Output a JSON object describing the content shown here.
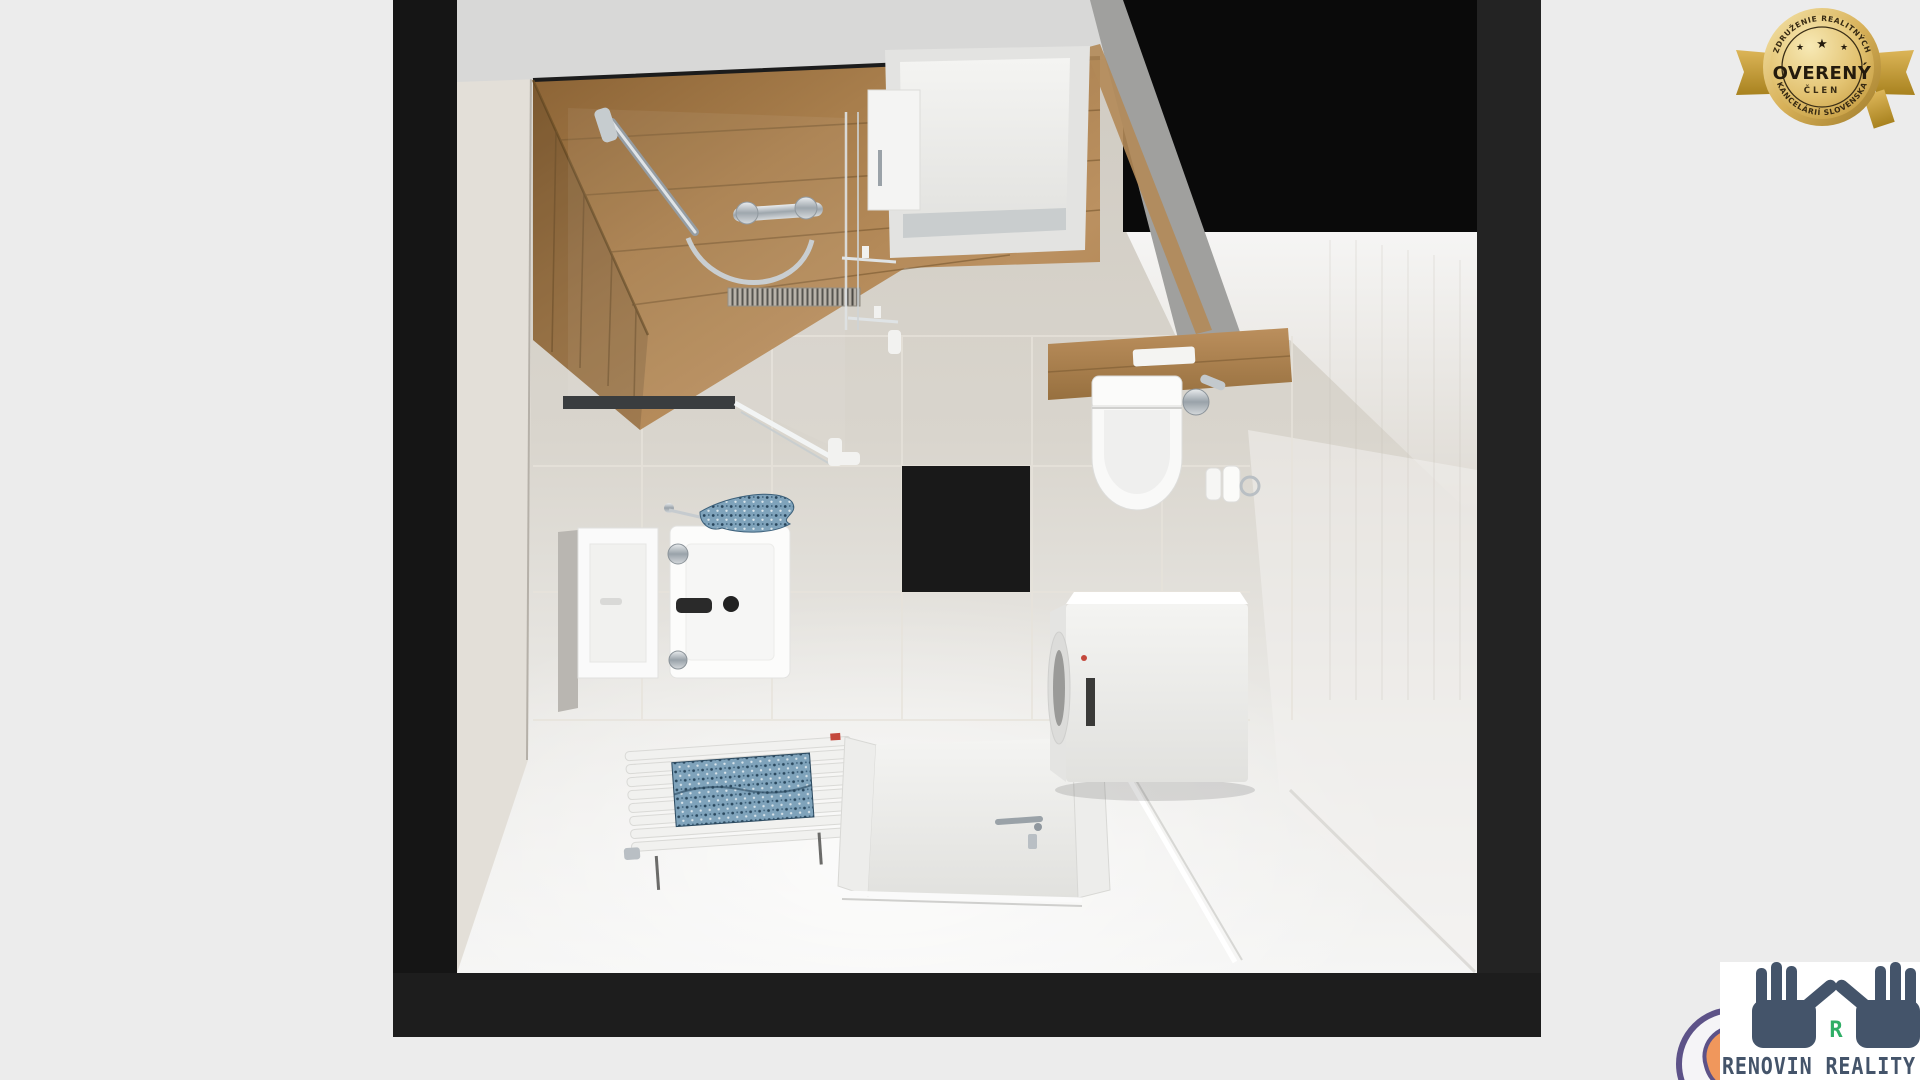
{
  "badge": {
    "top_arc": "ZDRUŽENIE REALITNÝCH",
    "star": "★",
    "title": "OVERENÝ",
    "subtitle": "ČLEN",
    "bottom_arc": "KANCELÁRIÍ SLOVENSKA"
  },
  "logo": {
    "company": "RENOVIN REALITY",
    "monogram": "R"
  },
  "colors": {
    "background": "#ececec",
    "frame_black": "#171717",
    "wood": "#b28a58",
    "wall_beige": "#cdc8bf",
    "towel_blue": "#6d93ad",
    "badge_gold": "#d7b255",
    "badge_text": "#2a2110",
    "logo_slate": "#44546a",
    "logo_green": "#2fae66",
    "logo_purple": "#5d5288",
    "logo_orange": "#f0975c"
  },
  "scene": {
    "type": "3d-top-down-bathroom-render",
    "objects": [
      "wood-panel-shower-corner",
      "shower-rail",
      "shower-mixer",
      "shower-glass-enclosure",
      "interior-door",
      "dark-opening",
      "toilet",
      "wood-toilet-shelf",
      "flush-plate",
      "toilet-paper-rolls",
      "black-wall-tile",
      "mirror",
      "countertop-washbasin",
      "black-faucet",
      "hand-towel",
      "towel-radiator",
      "bath-towel",
      "entrance-door",
      "washing-machine",
      "vent-grille"
    ]
  }
}
